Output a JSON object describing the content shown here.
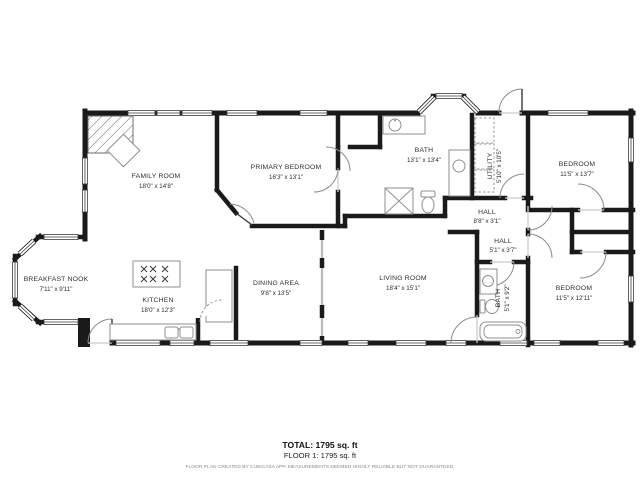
{
  "rooms": [
    {
      "name": "FAMILY ROOM",
      "dims": "18'0\" x 14'8\""
    },
    {
      "name": "PRIMARY BEDROOM",
      "dims": "16'3\" x 13'1\""
    },
    {
      "name": "BATH",
      "dims": "13'1\" x 13'4\""
    },
    {
      "name": "UTILITY",
      "dims": "5'10\" x 10'5\""
    },
    {
      "name": "BEDROOM",
      "dims": "11'5\" x 13'7\""
    },
    {
      "name": "HALL",
      "dims": "8'8\" x 3'1\""
    },
    {
      "name": "HALL",
      "dims": "5'1\" x 3'7\""
    },
    {
      "name": "BATH",
      "dims": "5'1\" x 9'2\""
    },
    {
      "name": "BEDROOM",
      "dims": "11'5\" x 12'11\""
    },
    {
      "name": "LIVING ROOM",
      "dims": "18'4\" x 15'1\""
    },
    {
      "name": "DINING AREA",
      "dims": "9'8\" x 13'5\""
    },
    {
      "name": "KITCHEN",
      "dims": "18'0\" x 12'3\""
    },
    {
      "name": "BREAKFAST NOOK",
      "dims": "7'11\" x 9'11\""
    }
  ],
  "footer": {
    "total": "TOTAL: 1795 sq. ft",
    "floor": "FLOOR 1: 1795 sq. ft",
    "disclaimer": "FLOOR PLAN CREATED BY CUBICASA APP. MEASUREMENTS DEEMED HIGHLY RELIABLE BUT NOT GUARANTEED."
  }
}
